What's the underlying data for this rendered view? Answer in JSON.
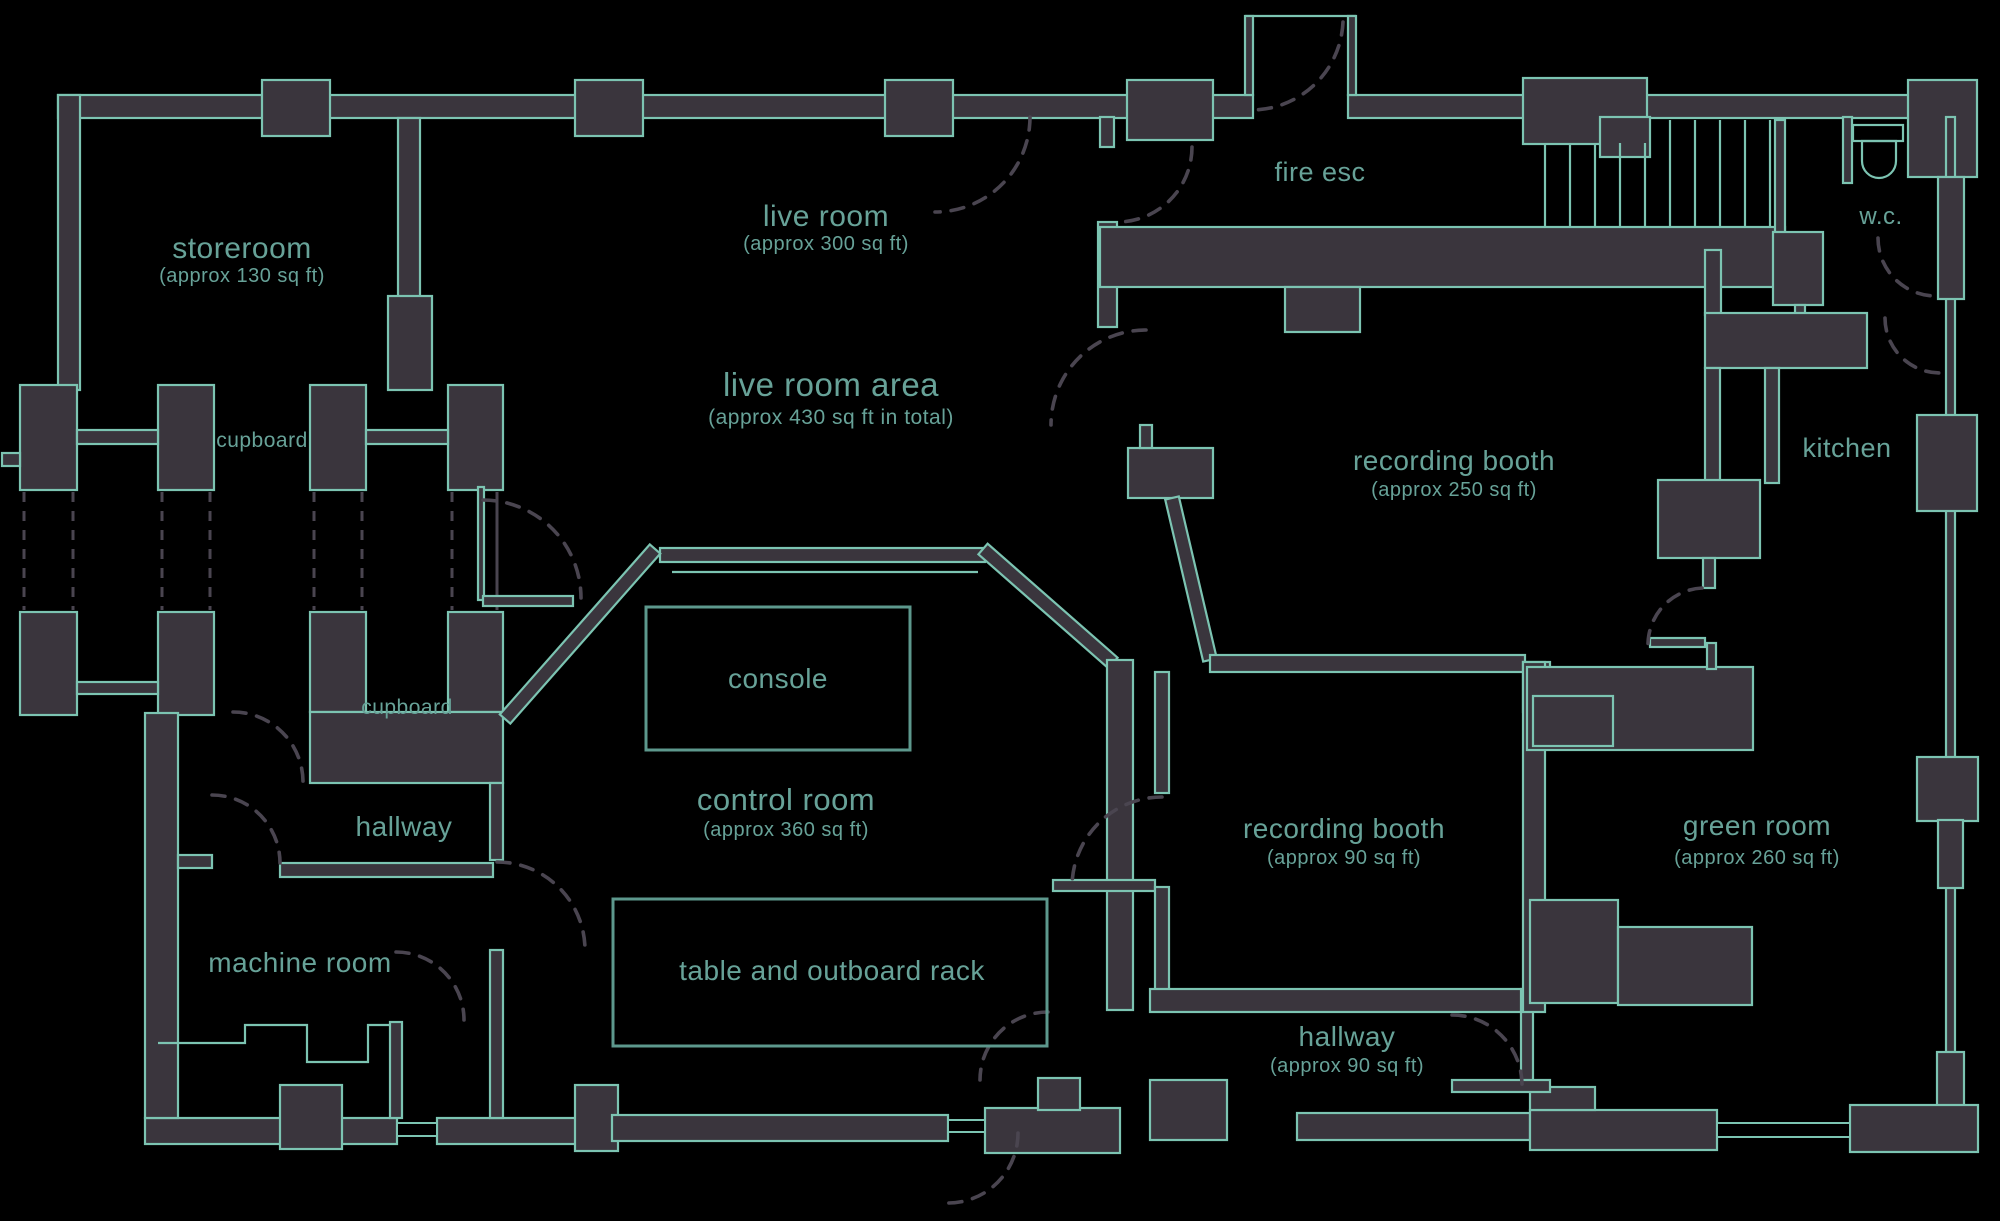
{
  "colors": {
    "background": "#000000",
    "wall_fill": "#3a353d",
    "wall_stroke": "#7cc4b2",
    "label": "#67a298",
    "dash": "#4a4550",
    "furn_stroke": "#5d988d"
  },
  "rooms": {
    "storeroom": {
      "label": "storeroom",
      "size": "(approx 130 sq ft)"
    },
    "live_room": {
      "label": "live room",
      "size": "(approx 300 sq ft)"
    },
    "live_room_area": {
      "label": "live room area",
      "size": "(approx 430 sq ft in total)"
    },
    "fire_esc": {
      "label": "fire esc"
    },
    "wc": {
      "label": "w.c."
    },
    "kitchen": {
      "label": "kitchen"
    },
    "recording_booth_large": {
      "label": "recording booth",
      "size": "(approx 250 sq ft)"
    },
    "recording_booth_small": {
      "label": "recording booth",
      "size": "(approx 90 sq ft)"
    },
    "control_room": {
      "label": "control room",
      "size": "(approx 360 sq ft)"
    },
    "green_room": {
      "label": "green room",
      "size": "(approx 260 sq ft)"
    },
    "hallway_upper": {
      "label": "hallway"
    },
    "hallway_lower": {
      "label": "hallway",
      "size": "(approx 90 sq ft)"
    },
    "machine_room": {
      "label": "machine room"
    },
    "cupboard_upper": {
      "label": "cupboard"
    },
    "cupboard_lower": {
      "label": "cupboard"
    }
  },
  "furniture": {
    "console": {
      "label": "console"
    },
    "table_rack": {
      "label": "table and outboard rack"
    }
  }
}
